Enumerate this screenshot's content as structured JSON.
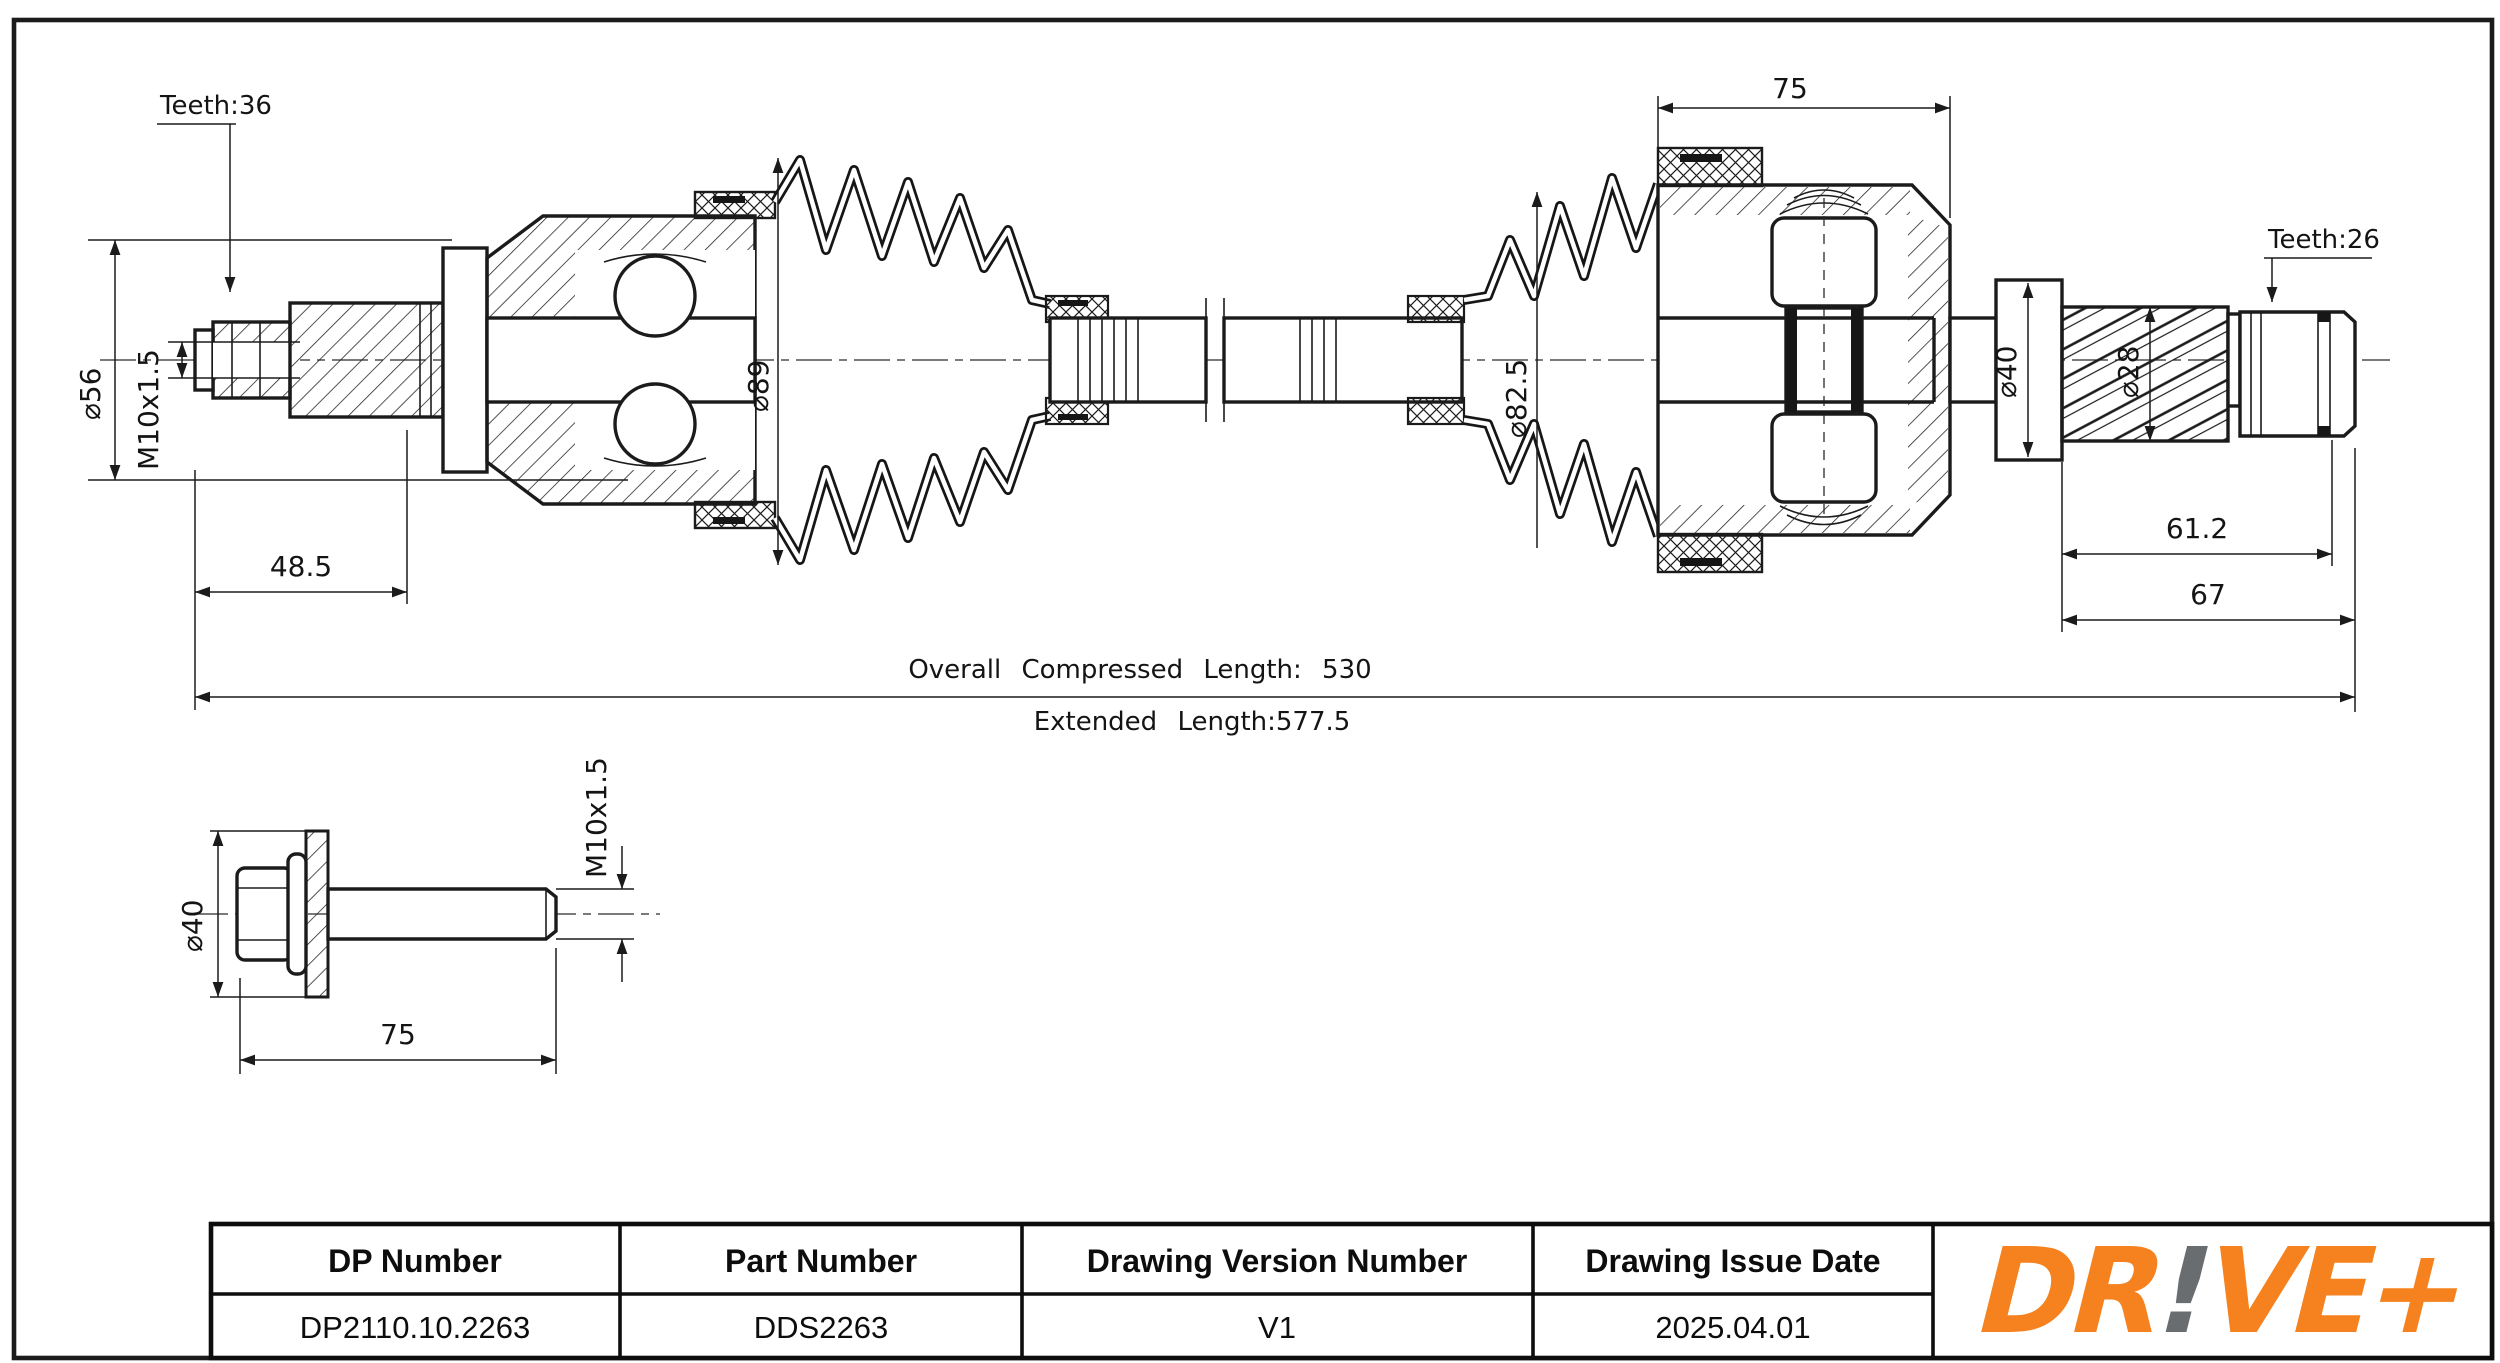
{
  "drawing": {
    "shaft_view": {
      "teeth_left": "Teeth:36",
      "teeth_right": "Teeth:26",
      "dia_flange": "⌀56",
      "thread_left": "M10x1.5",
      "dia_boot_left": "⌀89",
      "dia_boot_right": "⌀82.5",
      "dia_collar": "⌀40",
      "dia_thread_right": "⌀28",
      "housing_width": "75",
      "stub_left_length": "48.5",
      "thread_length_right": "61.2",
      "stub_right_length": "67",
      "overall_length": "Overall Compressed Length: 530",
      "extended_length": "Extended Length:577.5"
    },
    "bolt_view": {
      "dia_head": "⌀40",
      "thread": "M10x1.5",
      "length": "75"
    }
  },
  "title_block": {
    "headers": [
      "DP Number",
      "Part Number",
      "Drawing Version Number",
      "Drawing Issue Date"
    ],
    "values": [
      "DP2110.10.2263",
      "DDS2263",
      "V1",
      "2025.04.01"
    ],
    "logo": {
      "part1": "DR",
      "bang": "!",
      "part2": "VE+"
    },
    "logo_color": "#F5821F",
    "logo_bang_color": "#6A6D70"
  }
}
